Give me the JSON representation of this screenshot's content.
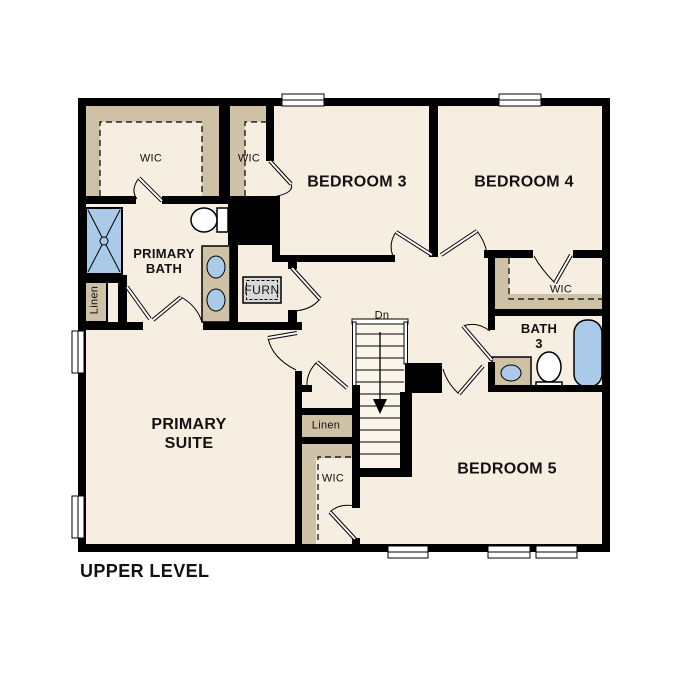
{
  "title": "UPPER LEVEL",
  "labels": {
    "wic_primary": "WIC",
    "wic_bedroom3": "WIC",
    "bedroom3": "BEDROOM 3",
    "bedroom4": "BEDROOM 4",
    "primary_bath": "PRIMARY\nBATH",
    "linen_left": "Linen",
    "furnace": "FURN",
    "primary_suite": "PRIMARY\nSUITE",
    "wic_bedroom4": "WIC",
    "bath3": "BATH\n3",
    "stairs_down": "Dn",
    "linen_hall": "Linen",
    "wic_bedroom5": "WIC",
    "bedroom5": "BEDROOM 5"
  },
  "colors": {
    "background": "#ffffff",
    "floor": "#f6efe1",
    "closet": "#cec1a5",
    "fixture": "#a9cae8",
    "wall": "#000000",
    "furn_fill": "#d9d9d9"
  }
}
